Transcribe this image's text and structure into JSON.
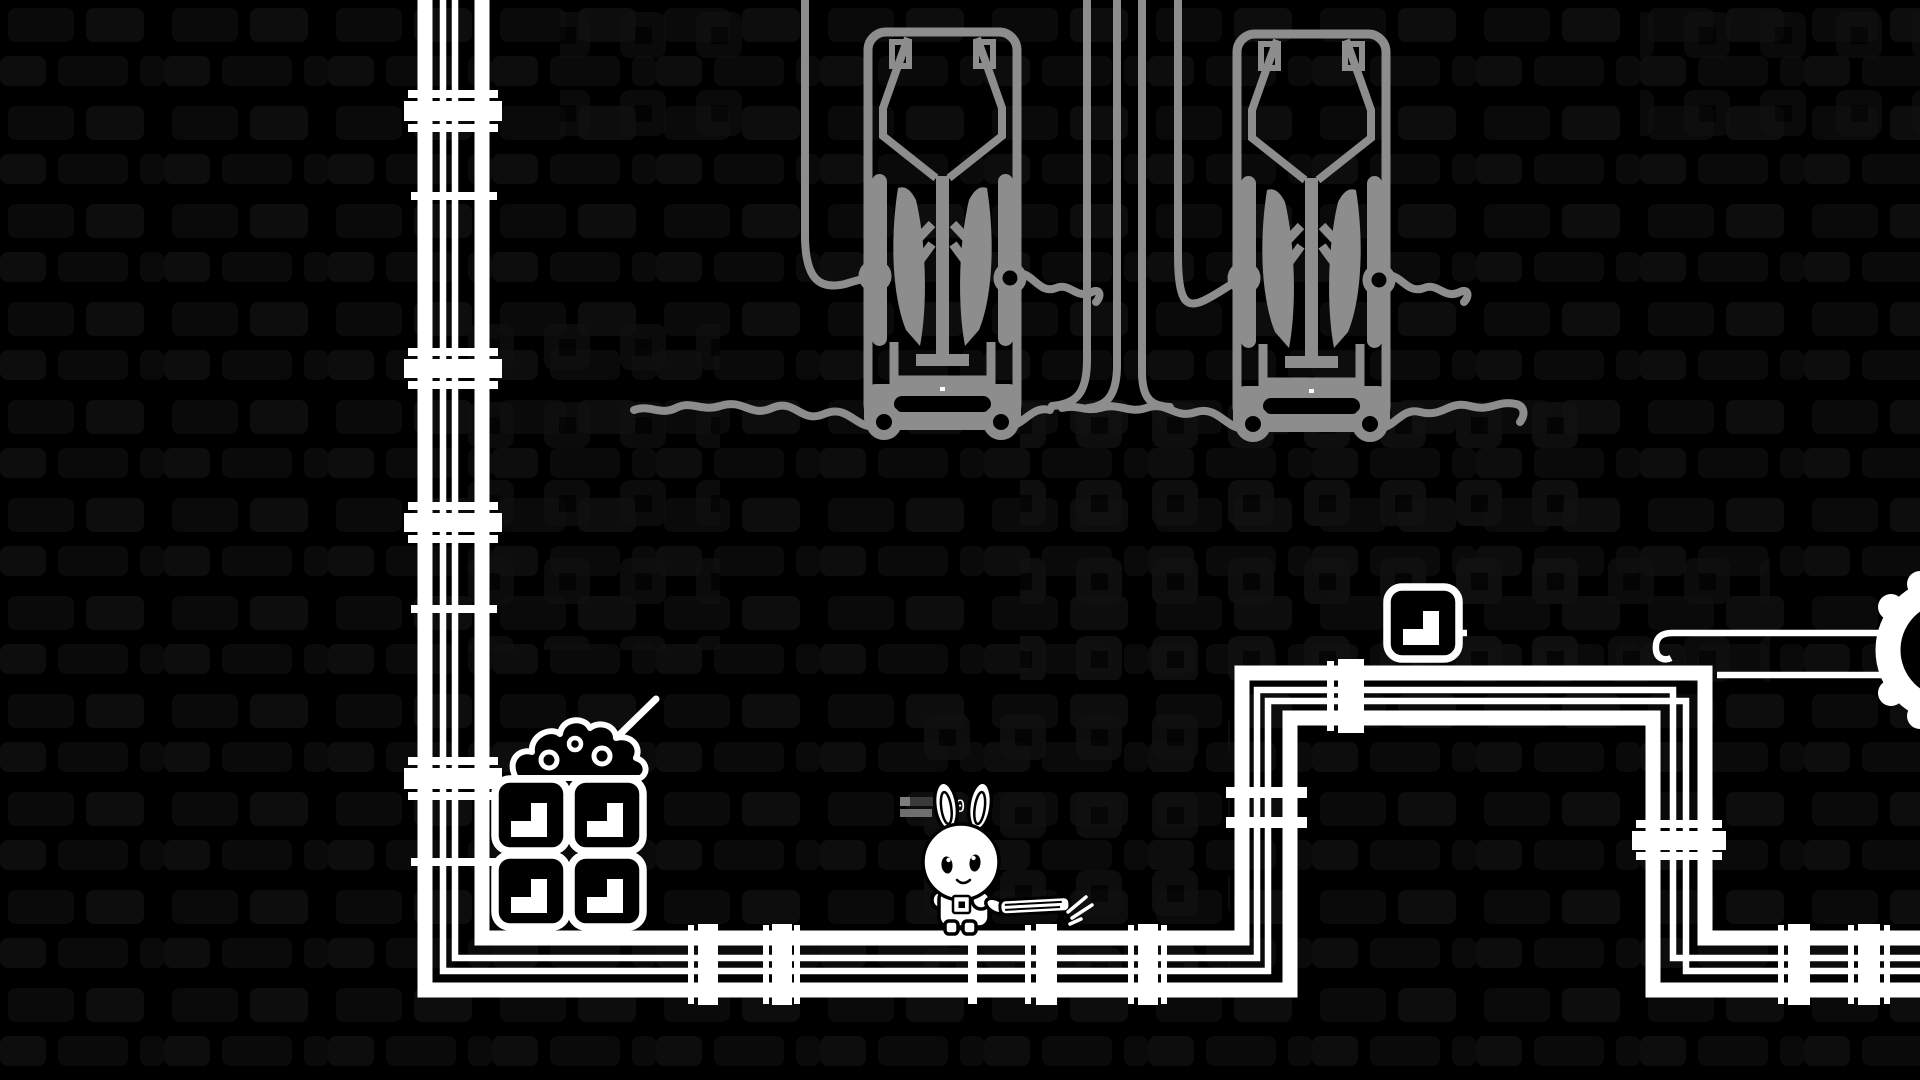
{
  "colors": {
    "bg": "#000000",
    "black": "#000000",
    "white": "#ffffff",
    "machine-gray": "#8d8d8d",
    "cable-gray": "#8d8d8d",
    "panel": "#0b0b0b",
    "panel2": "#0e0e0e",
    "vent": "#101010",
    "vent-inner": "#050505",
    "bar-light": "#7d7d7d",
    "bar-dark": "#3a3a3a",
    "bar-mid": "#6f6f6f"
  },
  "hud": {
    "counter": "0"
  },
  "scene": {
    "style": "black-and-white line-art game room",
    "player": {
      "character": "robot bunny",
      "pose": "standing on floor pipe, holding a striped plank",
      "location": "center-left on bottom pipe"
    },
    "objects": {
      "hanging_machines": 2,
      "crates_with_corner_glyph": 5,
      "rubble_pile": 1,
      "stick_in_rubble": 1,
      "gear_wheel_right_edge": 1,
      "pipe_runs": [
        "left vertical pipe",
        "floor pipe",
        "raised right pipe with two elbows",
        "bottom-right floor pipe"
      ],
      "ceiling_cables": 6
    }
  }
}
